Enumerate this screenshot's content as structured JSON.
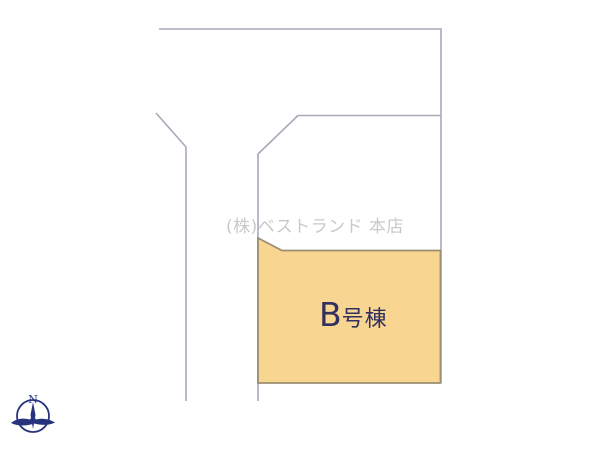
{
  "page": {
    "background": "#ffffff",
    "width": 600,
    "height": 450
  },
  "watermark": {
    "text": "(株)ベストランド 本店",
    "color": "#c9c9c9"
  },
  "parcel_b": {
    "label_prefix": "B",
    "label_suffix": "号棟",
    "label_color": "#31305e",
    "fill": "#F8D590",
    "stroke": "#9a8f72"
  },
  "lines": {
    "boundary_color": "#A6AAB9"
  },
  "compass": {
    "north_label": "N",
    "color": "#28337E"
  }
}
